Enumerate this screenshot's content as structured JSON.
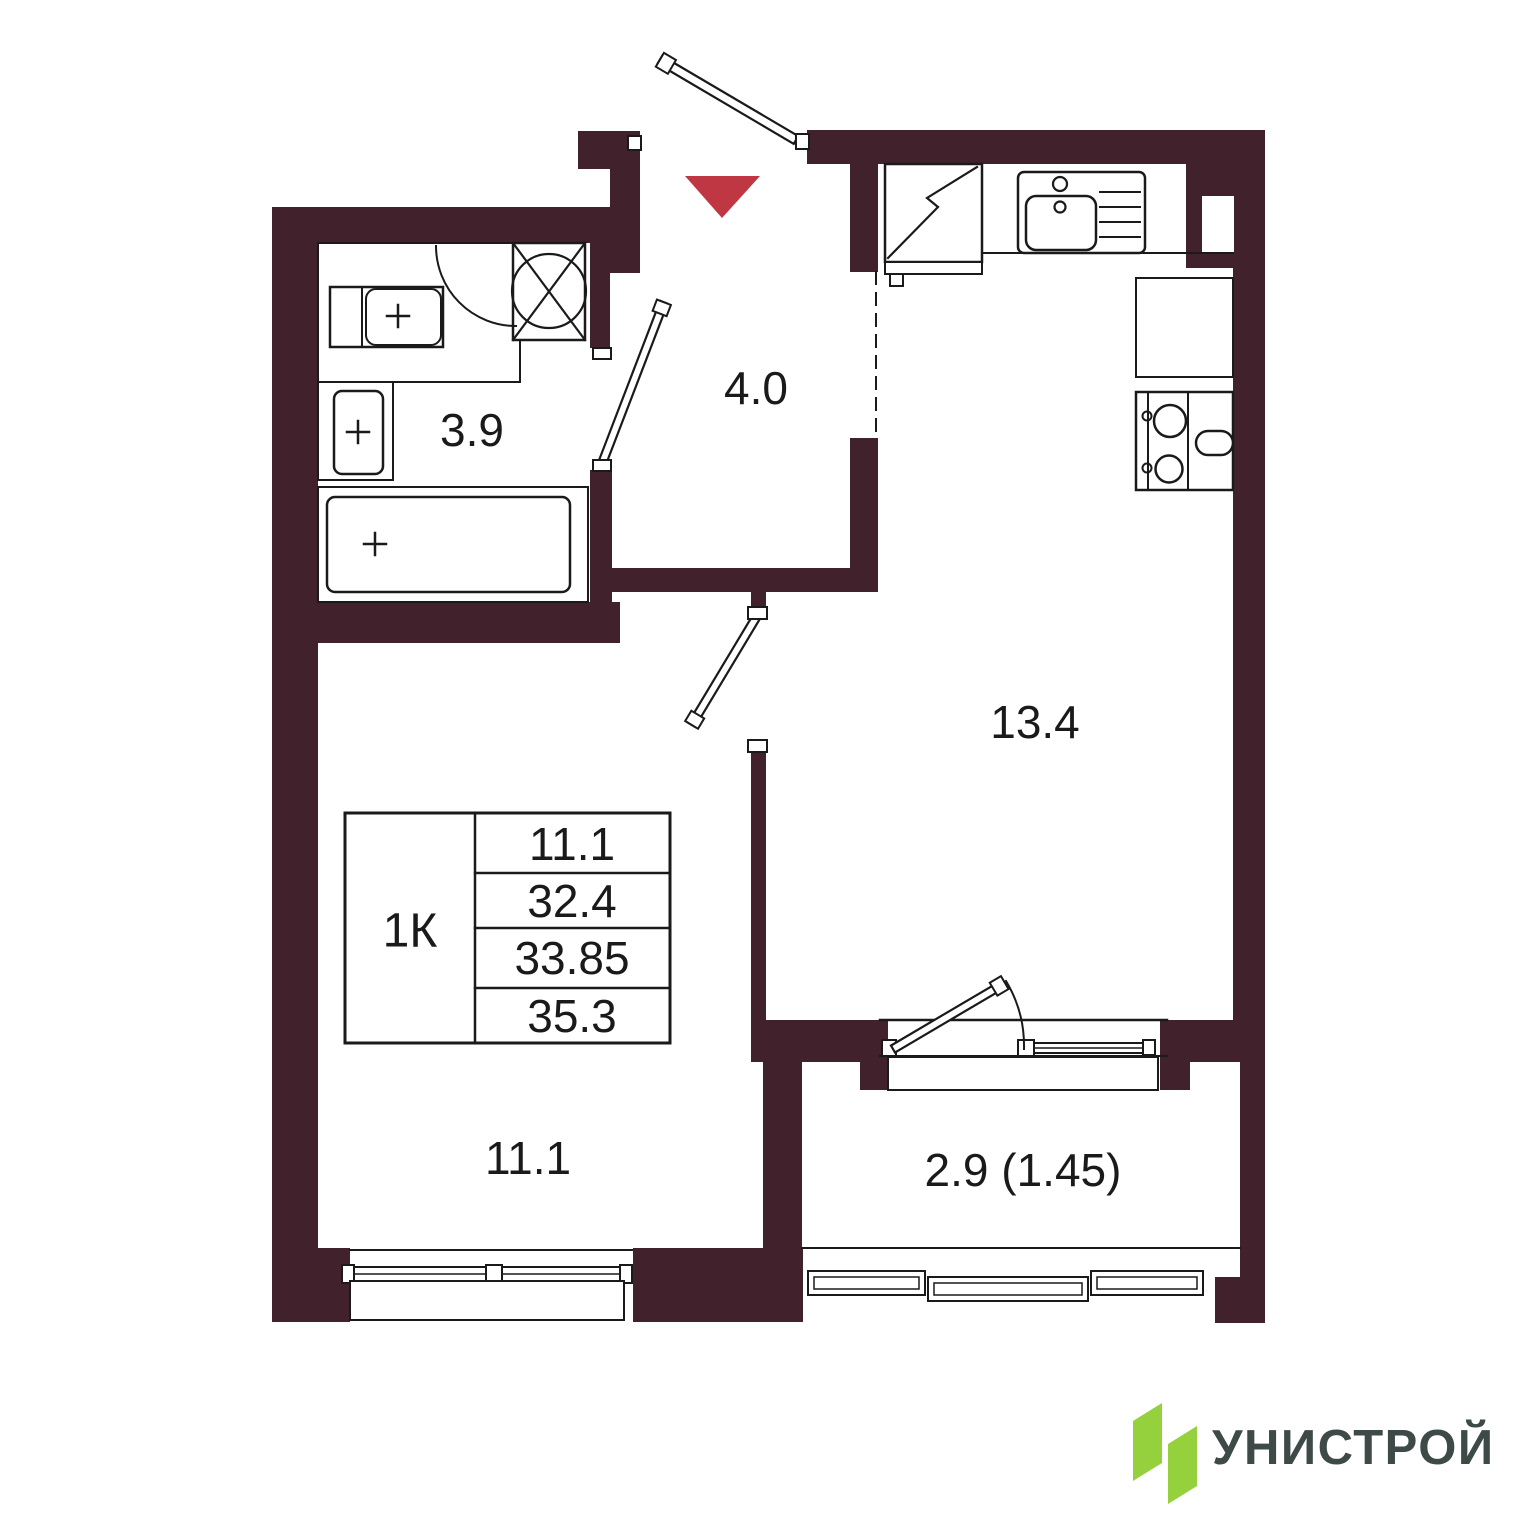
{
  "plan": {
    "rooms": [
      {
        "id": "hallway",
        "area_label": "4.0"
      },
      {
        "id": "bathroom",
        "area_label": "3.9"
      },
      {
        "id": "kitchen_living",
        "area_label": "13.4"
      },
      {
        "id": "bedroom",
        "area_label": "11.1"
      },
      {
        "id": "balcony",
        "area_label": "2.9 (1.45)"
      }
    ],
    "summary_table": {
      "type_label": "1К",
      "values": [
        "11.1",
        "32.4",
        "33.85",
        "35.3"
      ]
    },
    "entrance_marker_icon": "red-triangle-down"
  },
  "branding": {
    "logo_text": "УНИСТРОЙ"
  },
  "colors": {
    "wall": "#41222C",
    "line": "#1A1A1A",
    "accent_red": "#BE3742",
    "logo_green": "#94D13D",
    "logo_text": "#3E4A48",
    "background": "#FFFFFF"
  }
}
